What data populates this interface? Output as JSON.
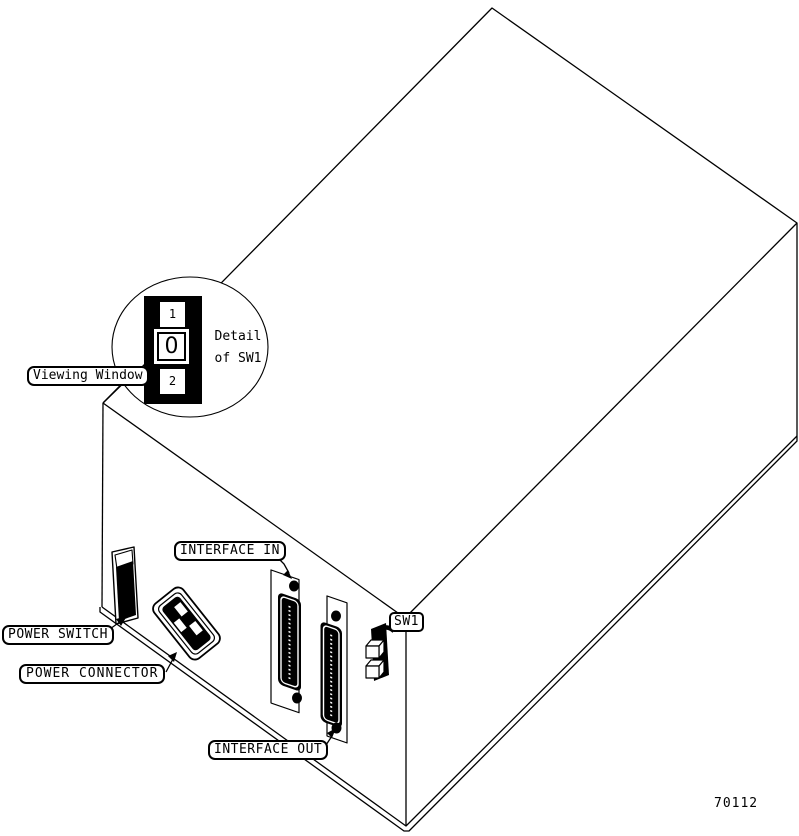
{
  "diagram": {
    "figure_number": "70112",
    "detail_callout": {
      "title_line1": "Detail",
      "title_line2": "of SW1",
      "position_top": "1",
      "position_middle": "0",
      "position_bottom": "2"
    },
    "labels": {
      "viewing_window": "Viewing Window",
      "power_switch": "POWER SWITCH",
      "power_connector": "POWER CONNECTOR",
      "interface_in": "INTERFACE IN",
      "interface_out": "INTERFACE OUT",
      "sw1": "SW1"
    },
    "colors": {
      "line": "#000000",
      "background": "#ffffff"
    }
  }
}
